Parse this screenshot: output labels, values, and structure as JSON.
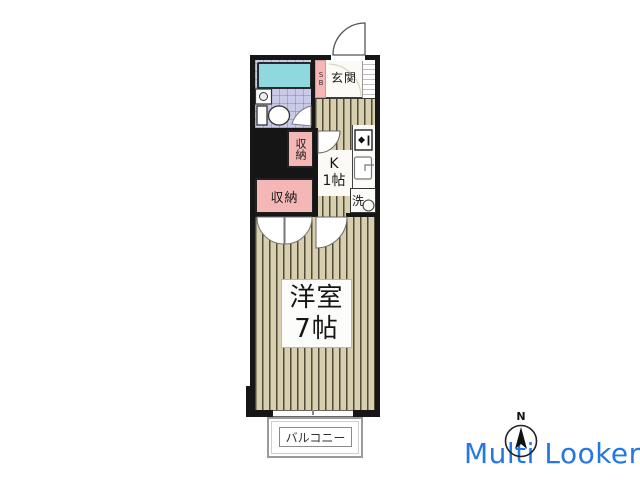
{
  "plan": {
    "entrance": {
      "label": "玄関",
      "shoebox": "SB"
    },
    "kitchen": {
      "line1": "K",
      "line2": "1帖"
    },
    "closet_small": {
      "label": "収納"
    },
    "closet_large": {
      "label": "収納"
    },
    "washer": {
      "label": "洗"
    },
    "room": {
      "line1": "洋室",
      "line2": "7帖"
    },
    "balcony": {
      "label": "バルコニー"
    }
  },
  "compass": {
    "north_label": "N"
  },
  "watermark": {
    "text": "Multi Looker",
    "color": "#2478e6"
  },
  "colors": {
    "wall": "#161616",
    "closet_pink": "#f5b6b6",
    "bathtub": "#8fd8de",
    "bath_tile": "#c9c9e8",
    "wood_base": "#d7cfae",
    "wood_line": "#4f4a3a",
    "balcony_border": "#9a9a9a",
    "watermark_blue": "#2478e6"
  }
}
